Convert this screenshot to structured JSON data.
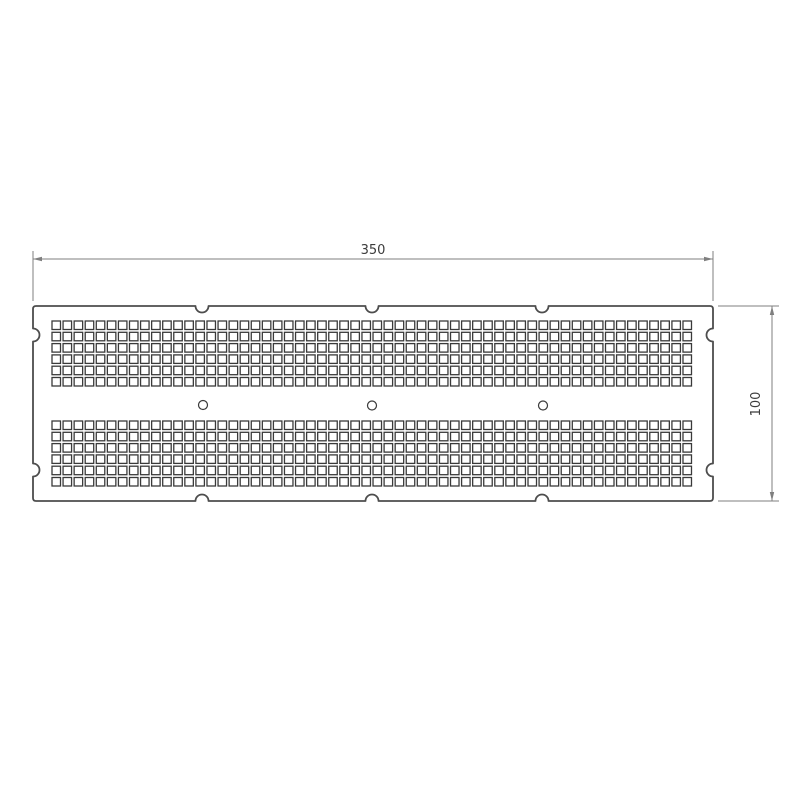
{
  "drawing": {
    "type": "technical_drawing",
    "subject": "perforated-plate",
    "part_width_units": 350,
    "part_height_units": 100
  },
  "dimensions": {
    "width": {
      "label": "350"
    },
    "height": {
      "label": "100"
    }
  },
  "colors": {
    "background": "#ffffff",
    "outline": "#4d4d4d",
    "perforation": "#3a3a3a",
    "dimension": "#7f7f7f",
    "text": "#3c3c3c"
  },
  "plate": {
    "x1": 33,
    "y1": 306,
    "x2": 713,
    "y2": 501,
    "corner_radius": 3,
    "notch_radius": 6.5,
    "top_notch_x": [
      202,
      372,
      542
    ],
    "bottom_notch_x": [
      202,
      372,
      542
    ],
    "left_notch_y": [
      335,
      470
    ],
    "right_notch_y": [
      335,
      470
    ],
    "outline_width": 1.8
  },
  "perforations": {
    "columns": 58,
    "rows_per_band": 6,
    "bands": 2,
    "start_x": 52,
    "band_tops": [
      321,
      421
    ],
    "pitch_x": 11.07,
    "pitch_y": 11.3,
    "square_size": 8.5,
    "stroke_width": 1.3
  },
  "holes": {
    "count": 3,
    "centers": [
      [
        203,
        405
      ],
      [
        372,
        405.5
      ],
      [
        543,
        405.5
      ]
    ],
    "radius": 4.5,
    "stroke_width": 1.2
  },
  "dim_top": {
    "line_y": 259,
    "x1": 33,
    "x2": 713,
    "ext_y1": 251,
    "ext_y2": 301,
    "label_x": 373,
    "label_y": 254
  },
  "dim_right": {
    "line_x": 772,
    "y1": 306,
    "y2": 501,
    "ext_x1": 718,
    "ext_x2": 779,
    "label_x": 760,
    "label_y": 404
  },
  "arrow": {
    "length": 9,
    "half_width": 2.2
  }
}
